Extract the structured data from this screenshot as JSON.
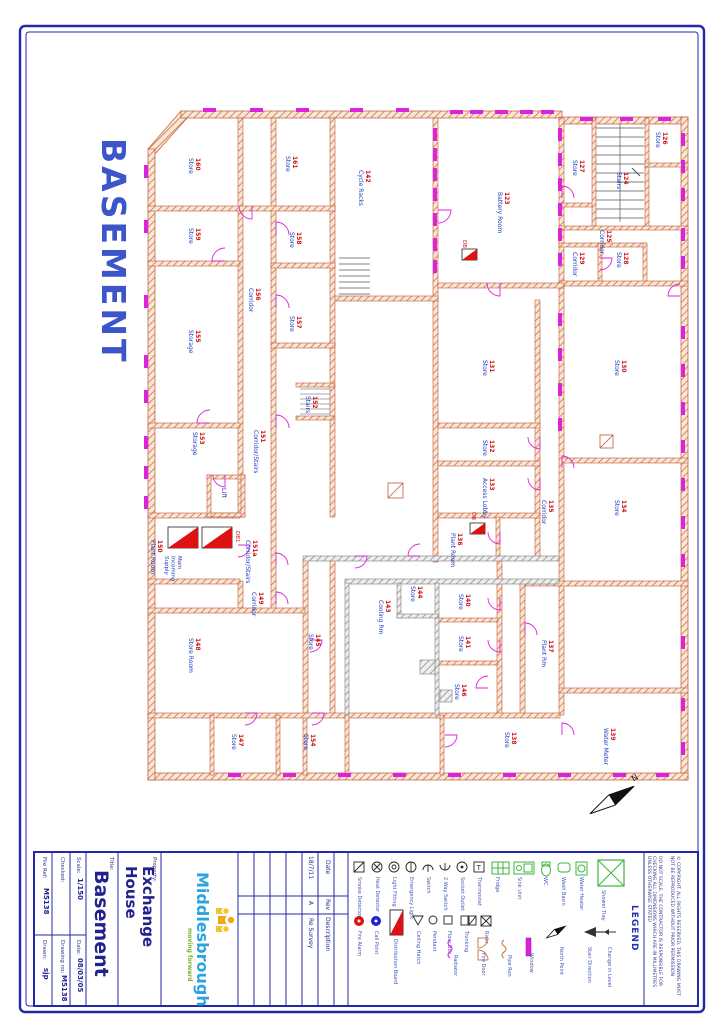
{
  "sheet": {
    "side_title": "BASEMENT",
    "north_label": "N"
  },
  "colors": {
    "border_blue": "#2228a8",
    "wall_orange": "#cd7a4a",
    "wall_gray": "#8f8f8f",
    "magenta": "#dd22dd",
    "room_number_red": "#cc1515",
    "room_name_blue": "#1f3bbf",
    "legend_green": "#3cb53c",
    "logo_blue": "#2ba3e0",
    "logo_green": "#7ab327",
    "logo_yellow": "#f0a818"
  },
  "title_block": {
    "file_ref_label": "File Ref:",
    "file_ref": "M5138",
    "drawn_label": "Drawn:",
    "drawn": "sjp",
    "checked_label": "Checked:",
    "checked": "",
    "drawing_no_label": "Drawing no:",
    "drawing_no": "M5138",
    "scale_label": "Scale:",
    "scale": "1/150",
    "date_label": "Date:",
    "date": "08/03/05",
    "title_label": "Title:",
    "title": "Basement",
    "property_label": "Property:",
    "property": "Exchange House",
    "logo_name": "Middlesbrough",
    "logo_tagline": "moving forward",
    "revisions": {
      "date_header": "Date",
      "rev_header": "Rev",
      "desc_header": "Description",
      "rows": [
        {
          "date": "18/7/11",
          "rev": "A",
          "desc": "Re Survey"
        }
      ]
    },
    "legend_title": "LEGEND",
    "do_not_scale": "DO NOT SCALE. THE CONTRACTOR IS RESPONSIBLE FOR CHECKING ALL DIMENSIONS WHICH ARE IN MILLIMETRES UNLESS OTHERWISE STATED",
    "copyright": "© COPYRIGHT. ALL RIGHTS RESERVED. THIS DRAWING MUST NOT BE REPRODUCED WITHOUT PRIOR PERMISSION"
  },
  "plan": {
    "rooms": [
      {
        "number": "160",
        "name": "Store",
        "x": 196,
        "y": 158
      },
      {
        "number": "161",
        "name": "Store",
        "x": 293,
        "y": 156
      },
      {
        "number": "142",
        "name": "Cycle Racks",
        "x": 366,
        "y": 170
      },
      {
        "number": "123",
        "name": "Battery Room",
        "x": 505,
        "y": 192
      },
      {
        "number": "126",
        "name": "Store",
        "x": 663,
        "y": 132
      },
      {
        "number": "127",
        "name": "Store",
        "x": 580,
        "y": 160
      },
      {
        "number": "124",
        "name": "Stairs",
        "x": 624,
        "y": 172
      },
      {
        "number": "125",
        "name": "Corridor",
        "x": 607,
        "y": 230
      },
      {
        "number": "128",
        "name": "Store",
        "x": 624,
        "y": 252
      },
      {
        "number": "129",
        "name": "Corridor",
        "x": 580,
        "y": 252
      },
      {
        "number": "159",
        "name": "Store",
        "x": 196,
        "y": 228
      },
      {
        "number": "158",
        "name": "Store",
        "x": 297,
        "y": 232
      },
      {
        "number": "156",
        "name": "Corridor",
        "x": 256,
        "y": 288
      },
      {
        "number": "157",
        "name": "Store",
        "x": 297,
        "y": 316
      },
      {
        "number": "155",
        "name": "Storage",
        "x": 196,
        "y": 330
      },
      {
        "number": "131",
        "name": "Store",
        "x": 490,
        "y": 360
      },
      {
        "number": "130",
        "name": "Store",
        "x": 622,
        "y": 360
      },
      {
        "number": "152",
        "name": "Stairs",
        "x": 313,
        "y": 396
      },
      {
        "number": "153",
        "name": "Storage",
        "x": 200,
        "y": 432
      },
      {
        "number": "151",
        "name": "Corridor/Stairs",
        "x": 261,
        "y": 430
      },
      {
        "number": "132",
        "name": "Store",
        "x": 490,
        "y": 440
      },
      {
        "number": "133",
        "name": "Access Lobby",
        "x": 490,
        "y": 478
      },
      {
        "number": "135",
        "name": "Corridor",
        "x": 549,
        "y": 500
      },
      {
        "number": "134",
        "name": "Store",
        "x": 622,
        "y": 500
      },
      {
        "number": "136",
        "name": "Plant Room",
        "x": 458,
        "y": 533
      },
      {
        "number": "150",
        "name": "Plant Room",
        "x": 158,
        "y": 540
      },
      {
        "number": "151a",
        "name": "Corridor/Stairs",
        "x": 253,
        "y": 540
      },
      {
        "number": "149",
        "name": "Corridor",
        "x": 259,
        "y": 592
      },
      {
        "number": "148",
        "name": "Store Room",
        "x": 196,
        "y": 638
      },
      {
        "number": "145",
        "name": "Store",
        "x": 316,
        "y": 634
      },
      {
        "number": "143",
        "name": "Cooling Rm",
        "x": 386,
        "y": 600
      },
      {
        "number": "144",
        "name": "Store",
        "x": 418,
        "y": 586
      },
      {
        "number": "140",
        "name": "Store",
        "x": 466,
        "y": 594
      },
      {
        "number": "141",
        "name": "Store",
        "x": 466,
        "y": 636
      },
      {
        "number": "146",
        "name": "Store",
        "x": 462,
        "y": 684
      },
      {
        "number": "147",
        "name": "Store",
        "x": 239,
        "y": 734
      },
      {
        "number": "154",
        "name": "Store",
        "x": 311,
        "y": 734
      },
      {
        "number": "137",
        "name": "Plant Rm",
        "x": 549,
        "y": 640
      },
      {
        "number": "138",
        "name": "Store",
        "x": 512,
        "y": 732
      },
      {
        "number": "139",
        "name": "Water Meter",
        "x": 611,
        "y": 728
      }
    ],
    "annotations": [
      {
        "lines": [
          "Main",
          "Incoming",
          "Supply"
        ],
        "x": 178,
        "y": 556,
        "color": "#1f3bbf",
        "size": 5.5
      },
      {
        "lines": [
          "DB1"
        ],
        "x": 236,
        "y": 531,
        "color": "#cc1515",
        "size": 5.5
      },
      {
        "lines": [
          "DB"
        ],
        "x": 463,
        "y": 240,
        "color": "#cc1515",
        "size": 5.5
      },
      {
        "lines": [
          "DB"
        ],
        "x": 472,
        "y": 512,
        "color": "#cc1515",
        "size": 5.5
      },
      {
        "lines": [
          "Lift"
        ],
        "x": 222,
        "y": 488,
        "color": "#1f3bbf",
        "size": 6.5
      }
    ],
    "windows_v": [
      [
        144,
        165
      ],
      [
        144,
        220
      ],
      [
        144,
        295
      ],
      [
        144,
        355
      ],
      [
        144,
        390
      ],
      [
        144,
        436
      ],
      [
        144,
        466
      ],
      [
        144,
        496
      ],
      [
        681,
        133
      ],
      [
        681,
        160
      ],
      [
        681,
        188
      ],
      [
        681,
        228
      ],
      [
        681,
        256
      ],
      [
        681,
        326
      ],
      [
        681,
        364
      ],
      [
        681,
        402
      ],
      [
        681,
        440
      ],
      [
        681,
        478
      ],
      [
        681,
        516
      ],
      [
        681,
        554
      ],
      [
        681,
        636
      ],
      [
        681,
        698
      ],
      [
        681,
        742
      ],
      [
        433,
        128
      ],
      [
        433,
        148
      ],
      [
        433,
        168
      ],
      [
        433,
        188
      ],
      [
        433,
        213
      ],
      [
        433,
        238
      ],
      [
        433,
        260
      ],
      [
        558,
        128
      ],
      [
        558,
        153
      ],
      [
        558,
        178
      ],
      [
        558,
        203
      ],
      [
        558,
        228
      ],
      [
        558,
        253
      ],
      [
        558,
        313
      ],
      [
        558,
        348
      ],
      [
        558,
        383
      ],
      [
        558,
        418
      ]
    ],
    "windows_h": [
      [
        203,
        108
      ],
      [
        250,
        108
      ],
      [
        296,
        108
      ],
      [
        350,
        108
      ],
      [
        396,
        108
      ],
      [
        450,
        110
      ],
      [
        470,
        110
      ],
      [
        495,
        110
      ],
      [
        520,
        110
      ],
      [
        541,
        110
      ],
      [
        580,
        117
      ],
      [
        620,
        117
      ],
      [
        658,
        117
      ],
      [
        228,
        773
      ],
      [
        283,
        773
      ],
      [
        338,
        773
      ],
      [
        393,
        773
      ],
      [
        448,
        773
      ],
      [
        503,
        773
      ],
      [
        558,
        773
      ],
      [
        613,
        773
      ],
      [
        656,
        773
      ]
    ],
    "doors": [
      [
        252,
        206,
        13,
        180
      ],
      [
        225,
        261,
        13,
        270
      ],
      [
        276,
        235,
        13,
        0
      ],
      [
        276,
        308,
        13,
        0
      ],
      [
        210,
        423,
        13,
        270
      ],
      [
        276,
        428,
        13,
        0
      ],
      [
        225,
        475,
        12,
        180
      ],
      [
        238,
        545,
        12,
        90
      ],
      [
        276,
        565,
        12,
        0
      ],
      [
        276,
        604,
        12,
        0
      ],
      [
        310,
        640,
        12,
        90
      ],
      [
        438,
        210,
        13,
        90
      ],
      [
        500,
        283,
        13,
        180
      ],
      [
        562,
        198,
        12,
        0
      ],
      [
        600,
        258,
        12,
        90
      ],
      [
        562,
        468,
        12,
        0
      ],
      [
        540,
        437,
        12,
        180
      ],
      [
        540,
        478,
        12,
        180
      ],
      [
        500,
        532,
        12,
        180
      ],
      [
        500,
        598,
        12,
        180
      ],
      [
        500,
        640,
        12,
        180
      ],
      [
        488,
        688,
        12,
        270
      ],
      [
        525,
        635,
        12,
        0
      ],
      [
        562,
        735,
        12,
        0
      ],
      [
        445,
        735,
        12,
        90
      ],
      [
        245,
        713,
        12,
        90
      ],
      [
        312,
        713,
        12,
        90
      ],
      [
        680,
        296,
        12,
        270
      ],
      [
        355,
        556,
        12,
        90
      ],
      [
        420,
        556,
        12,
        270
      ]
    ],
    "db_boards": [
      {
        "x": 168,
        "y": 527,
        "w": 30,
        "h": 21
      },
      {
        "x": 202,
        "y": 527,
        "w": 30,
        "h": 21
      },
      {
        "x": 462,
        "y": 249,
        "w": 15,
        "h": 11
      },
      {
        "x": 470,
        "y": 523,
        "w": 15,
        "h": 11
      }
    ]
  },
  "legend": {
    "items": [
      {
        "type": "sq-diag",
        "label": "Smoke Detector",
        "x": 354,
        "y": 862
      },
      {
        "type": "circ-x",
        "label": "Heat Detector",
        "x": 372,
        "y": 862
      },
      {
        "type": "circ-o",
        "label": "Light Fitting",
        "x": 389,
        "y": 862
      },
      {
        "type": "circ-o2",
        "label": "Emergency Light",
        "x": 406,
        "y": 862
      },
      {
        "type": "semi",
        "label": "Switch",
        "x": 423,
        "y": 862
      },
      {
        "type": "semi2",
        "label": "2 Way Switch",
        "x": 440,
        "y": 862
      },
      {
        "type": "circ-dot",
        "label": "Socket Outlet",
        "x": 457,
        "y": 862
      },
      {
        "type": "sq-t",
        "label": "Thermostat",
        "x": 474,
        "y": 862
      },
      {
        "type": "grid-green",
        "label": "Fridge",
        "x": 492,
        "y": 862
      },
      {
        "type": "sink-green",
        "label": "Sink Unit",
        "x": 514,
        "y": 862
      },
      {
        "type": "wc-green",
        "label": "WC",
        "x": 540,
        "y": 862
      },
      {
        "type": "basin-green",
        "label": "Wash Basin",
        "x": 558,
        "y": 862
      },
      {
        "type": "boiler-green",
        "label": "Water Heater",
        "x": 576,
        "y": 862
      },
      {
        "type": "shower-green",
        "label": "Shower Tray",
        "x": 598,
        "y": 860
      },
      {
        "type": "dot-red",
        "label": "Fire Alarm",
        "x": 354,
        "y": 916
      },
      {
        "type": "dot-blue",
        "label": "Call Point",
        "x": 371,
        "y": 916
      },
      {
        "type": "db-tri",
        "label": "Distribution Board",
        "x": 390,
        "y": 910
      },
      {
        "type": "tri-o",
        "label": "Ceiling Hatch",
        "x": 413,
        "y": 916
      },
      {
        "type": "circ-sm",
        "label": "Pendant",
        "x": 429,
        "y": 916
      },
      {
        "type": "sq-sm",
        "label": "Floor Box",
        "x": 444,
        "y": 916
      },
      {
        "type": "sq-pair",
        "label": "Trunking",
        "x": 461,
        "y": 916
      },
      {
        "type": "sq-x",
        "label": "Riser",
        "x": 481,
        "y": 916
      },
      {
        "type": "squig-m",
        "label": "Radiator",
        "x": 450,
        "y": 940
      },
      {
        "type": "door-o",
        "label": "Fire Door",
        "x": 478,
        "y": 938
      },
      {
        "type": "squig-o",
        "label": "Pipe Run",
        "x": 504,
        "y": 940
      },
      {
        "type": "bar-m",
        "label": "Window",
        "x": 526,
        "y": 938
      },
      {
        "type": "north-sm",
        "label": "North Point",
        "x": 556,
        "y": 932
      },
      {
        "type": "arrow-f",
        "label": "Stair Direction",
        "x": 584,
        "y": 932
      },
      {
        "type": "arrow-s",
        "label": "Change in Level",
        "x": 604,
        "y": 932
      }
    ]
  }
}
